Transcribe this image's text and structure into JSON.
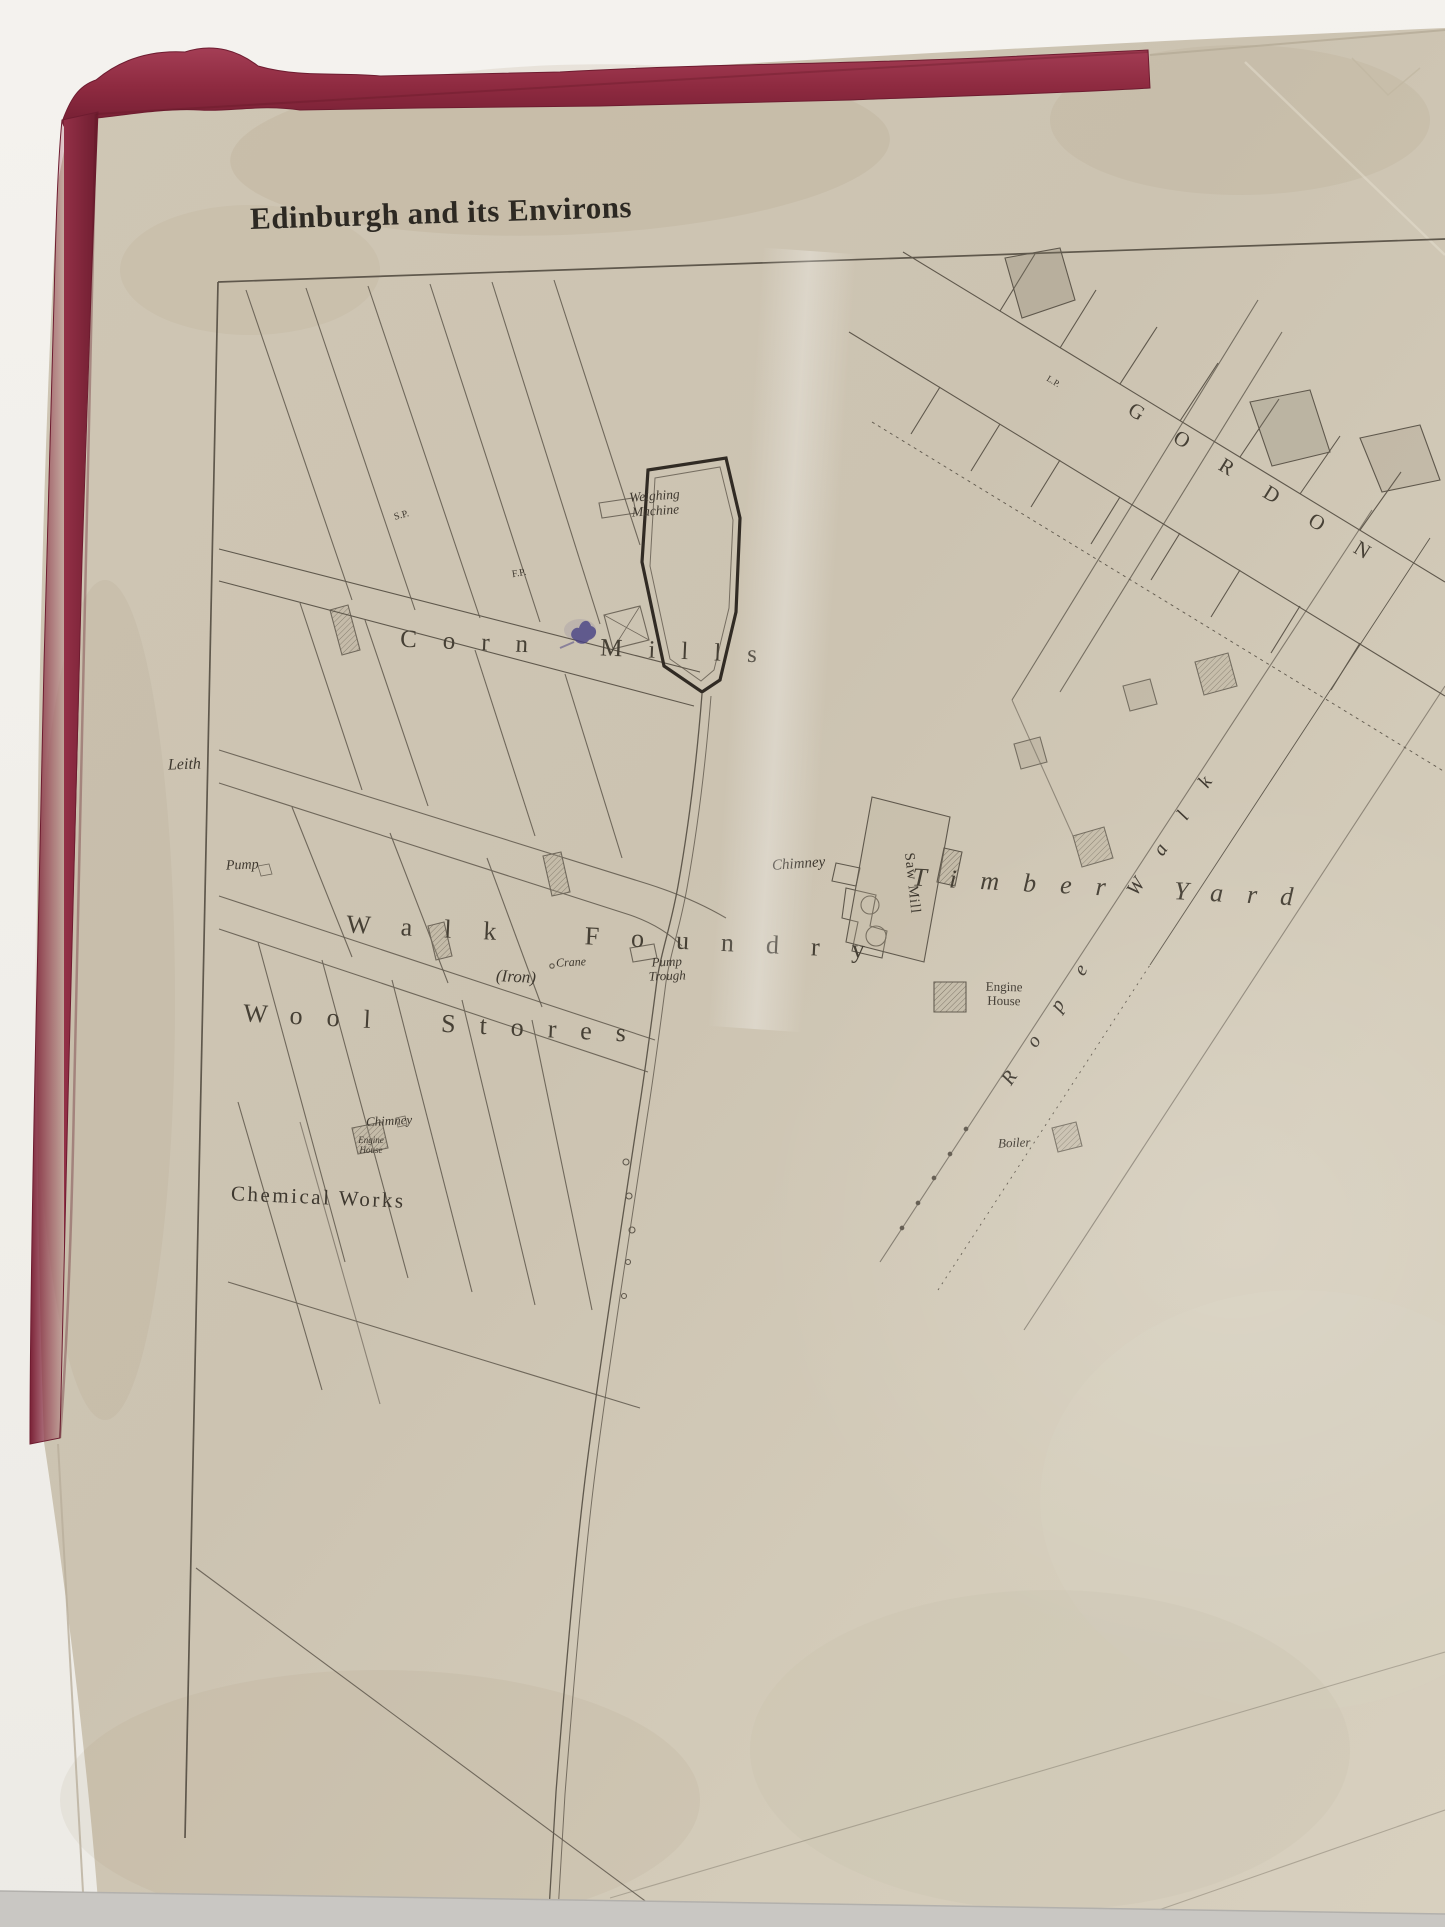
{
  "scene": {
    "description": "Photograph of an antique engraved town-plan sheet with crimson cloth binding, hung on a white wall",
    "wall_color": "#f2f0eb",
    "paper_color": "#cdc4b2",
    "binding_cloth_color": "#8e2a40",
    "ink_color": "#3e382f",
    "baseboard_shadow_color": "#c9c7c2"
  },
  "map": {
    "title": "Edinburgh and its Environs",
    "labels": {
      "leith": "Leith",
      "corn_mills": "Corn Mills",
      "weighing_machine": "Weighing Machine",
      "sp_mark": "S.P.",
      "fp_mark": "F.P.",
      "lp_mark": "L.P.",
      "walk_foundry": "Walk Foundry",
      "iron": "(Iron)",
      "crane": "Crane",
      "chimney_foundry": "Chimney",
      "saw_mill": "Saw Mill",
      "engine_house": "Engine House",
      "timber_yard": "Timber Yard",
      "rope_walk": "Rope Walk",
      "gordon_street": "GORDON",
      "pump": "Pump",
      "pump_trough": "Pump Trough",
      "wool_stores": "Wool Stores",
      "chimney_chemical": "Chimney",
      "engine_house_chemical": "Engine House",
      "chemical_works": "Chemical Works",
      "boiler": "Boiler"
    }
  }
}
